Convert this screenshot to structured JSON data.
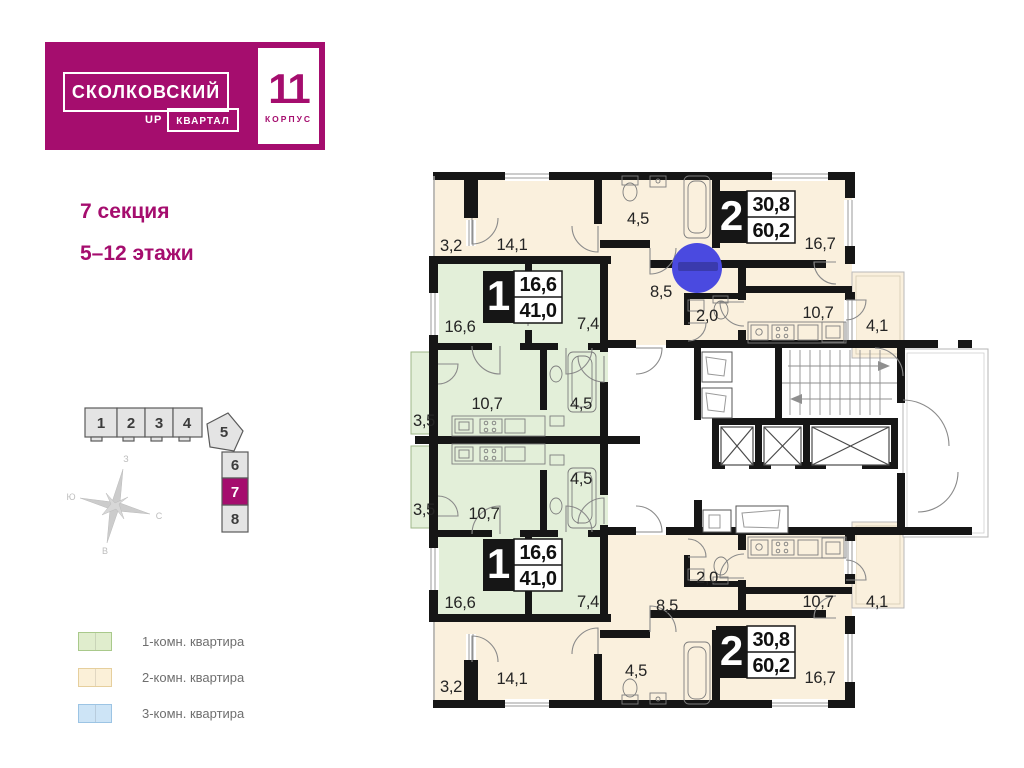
{
  "brand": {
    "name": "СКОЛКОВСКИЙ",
    "up": "UP",
    "kvartal": "КВАРТАЛ",
    "korpus_number": "11",
    "korpus_label": "КОРПУС"
  },
  "header": {
    "section_title": "7 секция",
    "floors": "5–12 этажи"
  },
  "minimap": {
    "sections": [
      "1",
      "2",
      "3",
      "4",
      "5",
      "6",
      "7",
      "8"
    ],
    "active_section": "7",
    "compass": {
      "top": "З",
      "left": "Ю",
      "right": "С",
      "bottom": "В"
    }
  },
  "legend": {
    "items": [
      {
        "label": "1-комн. квартира",
        "color": "#e0edcd",
        "border": "#a9c98b"
      },
      {
        "label": "2-комн. квартира",
        "color": "#fbf0d8",
        "border": "#e6cf9d"
      },
      {
        "label": "3-комн. квартира",
        "color": "#cde4f6",
        "border": "#9cc4e4"
      }
    ]
  },
  "plan": {
    "apt1": {
      "number": "1",
      "living_area": "16,6",
      "total_area": "41,0"
    },
    "apt2": {
      "number": "2",
      "living_area": "30,8",
      "total_area": "60,2"
    },
    "rooms": {
      "balcony_32": "3,2",
      "bedroom_141": "14,1",
      "bath_45": "4,5",
      "living_167": "16,7",
      "hall_85": "8,5",
      "wc_20": "2,0",
      "kitchen_107": "10,7",
      "balcony_41": "4,1",
      "living_166": "16,6",
      "hall_74": "7,4",
      "kitchen_107g": "10,7",
      "balcony_35": "3,5",
      "bath_45g": "4,5"
    },
    "colors": {
      "magenta": "#a50d6e",
      "one_room": "#e3efd9",
      "two_room": "#faf0dd",
      "wall": "#161616",
      "marker": "#4a4ae0",
      "marker_dark": "#3a3aad"
    }
  }
}
